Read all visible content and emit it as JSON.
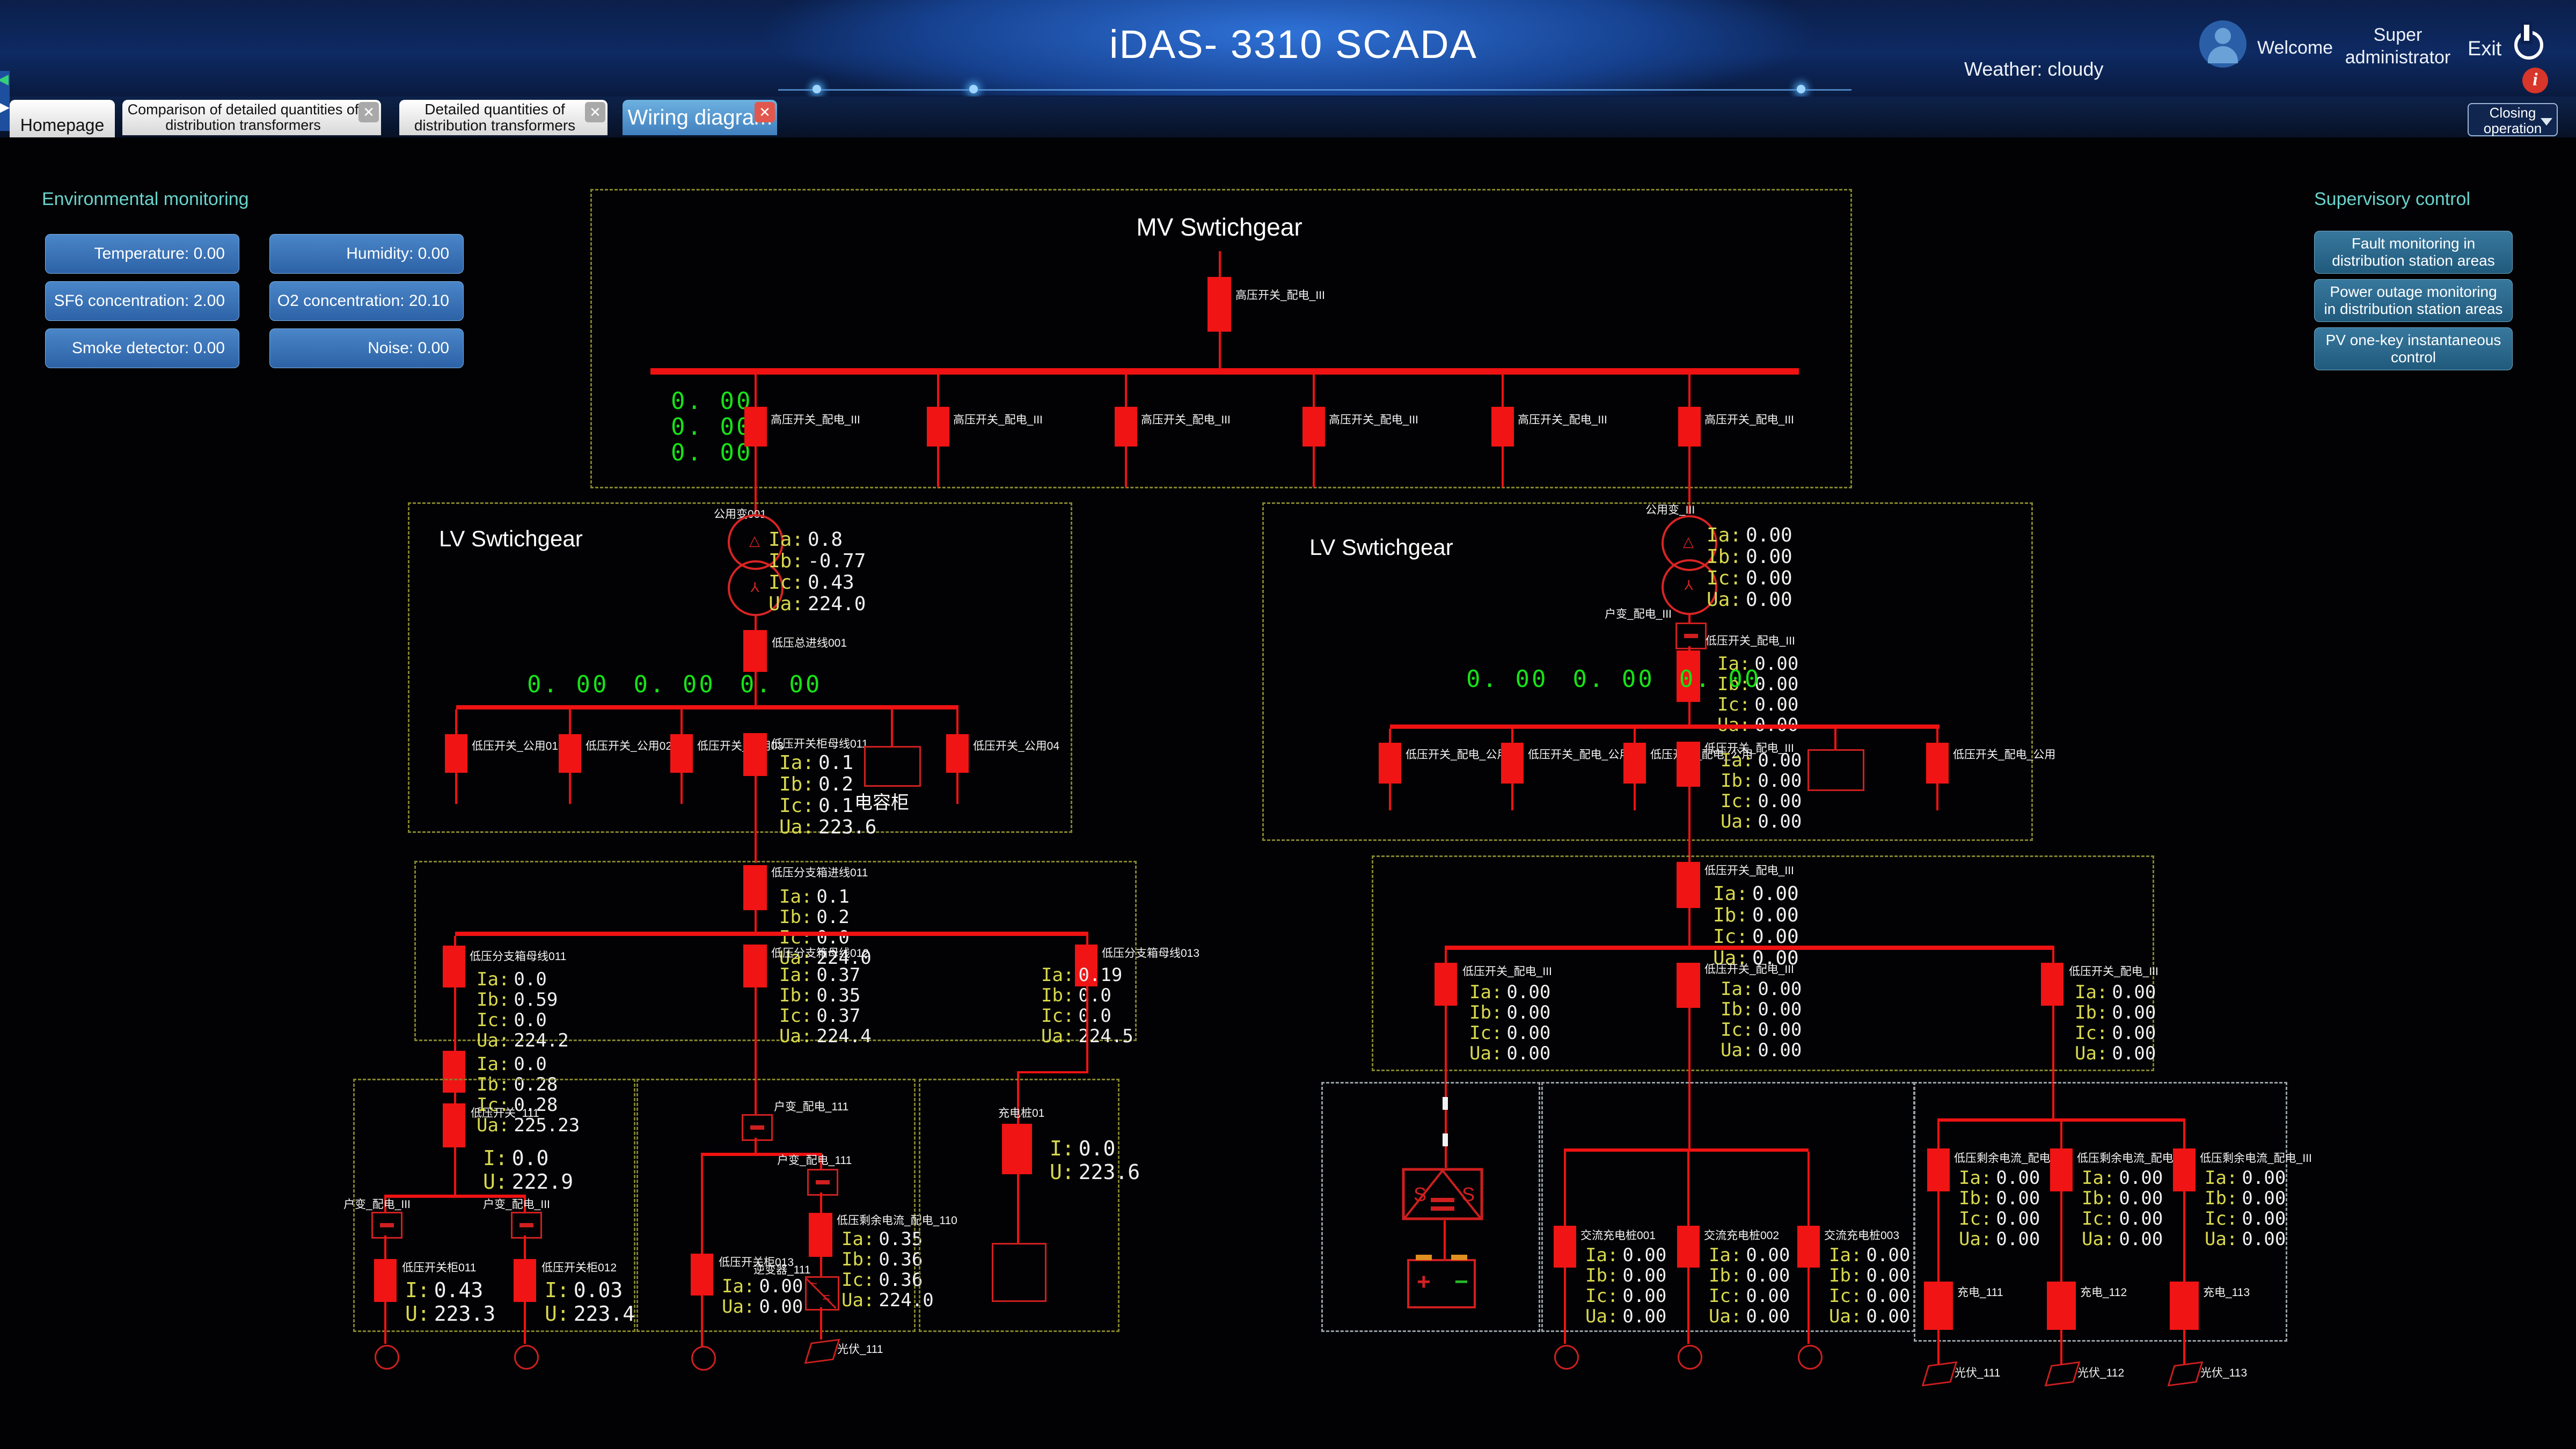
{
  "colors": {
    "accent_blue": "#2f72d8",
    "line_red": "#ef1212",
    "value_green": "#17e217",
    "panel_cyan": "#69d3cd",
    "alert_red": "#d8352b"
  },
  "header": {
    "title": "iDAS- 3310 SCADA",
    "weather": "Weather: cloudy",
    "welcome": "Welcome",
    "user_line1": "Super",
    "user_line2": "administrator",
    "exit": "Exit"
  },
  "tabs": [
    {
      "label": "Homepage"
    },
    {
      "label": "Comparison of detailed quantities of distribution transformers"
    },
    {
      "label": "Detailed quantities of distribution transformers"
    },
    {
      "label": "Wiring diagram"
    }
  ],
  "closing_operation": "Closing operation",
  "env": {
    "title": "Environmental monitoring",
    "buttons": [
      "Temperature: 0.00",
      "Humidity: 0.00",
      "SF6 concentration: 2.00",
      "O2 concentration: 20.10",
      "Smoke detector: 0.00",
      "Noise: 0.00"
    ]
  },
  "supervisory": {
    "title": "Supervisory control",
    "buttons": [
      "Fault monitoring in distribution station areas",
      "Power outage monitoring in distribution station areas",
      "PV one-key instantaneous control"
    ]
  },
  "mv": {
    "title": "MV Swtichgear",
    "incoming_label": "高压开关_配电_III",
    "feeder_labels": [
      "高压开关_配电_III",
      "高压开关_配电_III",
      "高压开关_配电_III",
      "高压开关_配电_III",
      "高压开关_配电_III",
      "高压开关_配电_III"
    ],
    "green": [
      "0. 00",
      "0. 00",
      "0. 00"
    ]
  },
  "lv_left": {
    "title": "LV Swtichgear",
    "transformer_label": "公用变001",
    "t_readings": [
      [
        "Ia:",
        "0.8"
      ],
      [
        "Ib:",
        "-0.77"
      ],
      [
        "Ic:",
        "0.43"
      ],
      [
        "Ua:",
        "224.0"
      ]
    ],
    "main_label": "低压总进线001",
    "green": [
      "0. 00",
      "0. 00",
      "0. 00"
    ],
    "feeder_labels": [
      "低压开关_公用01",
      "低压开关_公用02",
      "低压开关_公用03"
    ],
    "center_label": "低压开关柜母线011",
    "right_label": "低压开关_公用04",
    "c_readings": [
      [
        "Ia:",
        "0.1"
      ],
      [
        "Ib:",
        "0.2"
      ],
      [
        "Ic:",
        "0.1"
      ],
      [
        "Ua:",
        "223.6"
      ]
    ],
    "cap_label": "电容柜"
  },
  "lv_right": {
    "title": "LV Swtichgear",
    "transformer_label": "公用变_III",
    "t_readings": [
      [
        "Ia:",
        "0.00"
      ],
      [
        "Ib:",
        "0.00"
      ],
      [
        "Ic:",
        "0.00"
      ],
      [
        "Ua:",
        "0.00"
      ]
    ],
    "switch_label": "户变_配电_III",
    "main_label": "低压开关_配电_III",
    "b_readings": [
      [
        "Ia:",
        "0.00"
      ],
      [
        "Ib:",
        "0.00"
      ],
      [
        "Ic:",
        "0.00"
      ],
      [
        "Ua:",
        "0.00"
      ]
    ],
    "green": [
      "0. 00",
      "0. 00",
      "0. 00"
    ],
    "feeder_labels": [
      "低压开关_配电_公用",
      "低压开关_配电_公用",
      "低压开关_配电_公用"
    ],
    "center_label": "低压开关_配电_III",
    "c_readings": [
      [
        "Ia:",
        "0.00"
      ],
      [
        "Ib:",
        "0.00"
      ],
      [
        "Ic:",
        "0.00"
      ],
      [
        "Ua:",
        "0.00"
      ]
    ],
    "right_label": "低压开关_配电_公用"
  },
  "mid_left": {
    "top_label": "低压分支箱进线011",
    "top": [
      [
        "Ia:",
        "0.1"
      ],
      [
        "Ib:",
        "0.2"
      ],
      [
        "Ic:",
        "0.0"
      ],
      [
        "Ua:",
        "224.0"
      ]
    ],
    "left_label": "低压分支箱母线011",
    "left": [
      [
        "Ia:",
        "0.0"
      ],
      [
        "Ib:",
        "0.59"
      ],
      [
        "Ic:",
        "0.0"
      ],
      [
        "Ua:",
        "224.2"
      ]
    ],
    "center_label": "低压分支箱母线012",
    "center": [
      [
        "Ia:",
        "0.37"
      ],
      [
        "Ib:",
        "0.35"
      ],
      [
        "Ic:",
        "0.37"
      ],
      [
        "Ua:",
        "224.4"
      ]
    ],
    "right_label": "低压分支箱母线013",
    "right": [
      [
        "Ia:",
        "0.19"
      ],
      [
        "Ib:",
        "0.0"
      ],
      [
        "Ic:",
        "0.0"
      ],
      [
        "Ua:",
        "224.5"
      ]
    ]
  },
  "mid_right": {
    "top_label": "低压开关_配电_III",
    "top": [
      [
        "Ia:",
        "0.00"
      ],
      [
        "Ib:",
        "0.00"
      ],
      [
        "Ic:",
        "0.00"
      ],
      [
        "Ua:",
        "0.00"
      ]
    ],
    "left_label": "低压开关_配电_III",
    "left": [
      [
        "Ia:",
        "0.00"
      ],
      [
        "Ib:",
        "0.00"
      ],
      [
        "Ic:",
        "0.00"
      ],
      [
        "Ua:",
        "0.00"
      ]
    ],
    "center_label": "低压开关_配电_III",
    "center": [
      [
        "Ia:",
        "0.00"
      ],
      [
        "Ib:",
        "0.00"
      ],
      [
        "Ic:",
        "0.00"
      ],
      [
        "Ua:",
        "0.00"
      ]
    ],
    "right_label": "低压开关_配电_III",
    "right": [
      [
        "Ia:",
        "0.00"
      ],
      [
        "Ib:",
        "0.00"
      ],
      [
        "Ic:",
        "0.00"
      ],
      [
        "Ua:",
        "0.00"
      ]
    ]
  },
  "bottom": {
    "pre_a": [
      [
        "Ia:",
        "0.0"
      ],
      [
        "Ib:",
        "0.28"
      ],
      [
        "Ic:",
        "0.28"
      ],
      [
        "Ua:",
        "225.23"
      ]
    ],
    "a_main_label": "低压开关_111",
    "a_main": [
      [
        "I:",
        "0.0"
      ],
      [
        "U:",
        "222.9"
      ]
    ],
    "a_switch_labels": [
      "户变_配电_III",
      "户变_配电_III"
    ],
    "a_left_label": "低压开关柜011",
    "a_left": [
      [
        "I:",
        "0.43"
      ],
      [
        "U:",
        "223.3"
      ]
    ],
    "a_right_label": "低压开关柜012",
    "a_right": [
      [
        "I:",
        "0.03"
      ],
      [
        "U:",
        "223.4"
      ]
    ],
    "b_top_switch_label": "户变_配电_111",
    "b_left_label": "低压开关柜013",
    "b_left": [
      [
        "Ia:",
        "0.00"
      ],
      [
        "Ua:",
        "0.00"
      ]
    ],
    "b_switch_label": "户变_配电_111",
    "b_right_label": "低压剩余电流_配电_110",
    "b_right": [
      [
        "Ia:",
        "0.35"
      ],
      [
        "Ib:",
        "0.36"
      ],
      [
        "Ic:",
        "0.36"
      ],
      [
        "Ua:",
        "224.0"
      ]
    ],
    "b_inverter_label": "逆变器_111",
    "b_pv_label": "光伏_111",
    "c_label": "充电桩01",
    "c_main": [
      [
        "I:",
        "0.0"
      ],
      [
        "U:",
        "223.6"
      ]
    ],
    "e_labels": [
      "交流充电桩001",
      "交流充电桩002",
      "交流充电桩003"
    ],
    "e": [
      [
        [
          "Ia:",
          "0.00"
        ],
        [
          "Ib:",
          "0.00"
        ],
        [
          "Ic:",
          "0.00"
        ],
        [
          "Ua:",
          "0.00"
        ]
      ],
      [
        [
          "Ia:",
          "0.00"
        ],
        [
          "Ib:",
          "0.00"
        ],
        [
          "Ic:",
          "0.00"
        ],
        [
          "Ua:",
          "0.00"
        ]
      ],
      [
        [
          "Ia:",
          "0.00"
        ],
        [
          "Ib:",
          "0.00"
        ],
        [
          "Ic:",
          "0.00"
        ],
        [
          "Ua:",
          "0.00"
        ]
      ]
    ],
    "f_labels": [
      "低压剩余电流_配电_III",
      "低压剩余电流_配电_III",
      "低压剩余电流_配电_III"
    ],
    "f": [
      [
        [
          "Ia:",
          "0.00"
        ],
        [
          "Ib:",
          "0.00"
        ],
        [
          "Ic:",
          "0.00"
        ],
        [
          "Ua:",
          "0.00"
        ]
      ],
      [
        [
          "Ia:",
          "0.00"
        ],
        [
          "Ib:",
          "0.00"
        ],
        [
          "Ic:",
          "0.00"
        ],
        [
          "Ua:",
          "0.00"
        ]
      ],
      [
        [
          "Ia:",
          "0.00"
        ],
        [
          "Ib:",
          "0.00"
        ],
        [
          "Ic:",
          "0.00"
        ],
        [
          "Ua:",
          "0.00"
        ]
      ]
    ],
    "f_chg": [
      "充电_111",
      "充电_112",
      "充电_113"
    ],
    "f_pv": [
      "光伏_111",
      "光伏_112",
      "光伏_113"
    ]
  }
}
